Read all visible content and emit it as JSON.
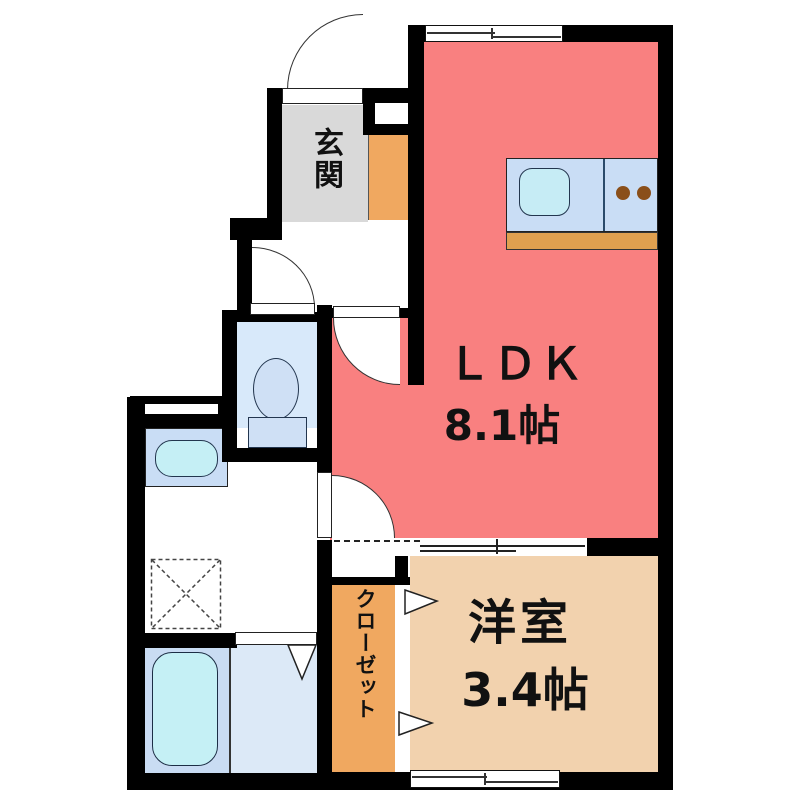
{
  "plan": {
    "rooms": {
      "ldk": {
        "label": "ＬＤＫ",
        "size": "8.1帖",
        "color": "#f98080"
      },
      "western_room": {
        "label": "洋室",
        "size": "3.4帖",
        "color": "#f2d2ae"
      },
      "entrance": {
        "label": "玄関",
        "color": "#d9d9d9"
      },
      "closet": {
        "label": "クローゼット",
        "color": "#f0a860"
      }
    },
    "fixtures": {
      "kitchen_counter": "kitchen-counter-with-sink-and-two-burner-stove",
      "toilet": "toilet",
      "washbasin": "washbasin-counter",
      "washing_machine_pan": "washing-machine-pan",
      "bathtub": "bathtub",
      "bathroom_folding_door": "folding-door",
      "closet_folding_doors": "folding-doors",
      "sliding_window_north": "sliding-window",
      "sliding_window_south": "sliding-window",
      "sliding_partition": "sliding-partition"
    },
    "colors": {
      "wall": "#000000",
      "ldk_red": "#f98080",
      "western_tan": "#f2d2ae",
      "orange": "#f0a860",
      "counter_base_orange": "#e0a04f",
      "entrance_gray": "#d9d9d9",
      "fixture_blue": "#cfe0f5",
      "counter_blue": "#c9ddf5",
      "water_cyan": "#c5eff5",
      "toilet_floor_blue": "#d8e9fa",
      "bathroom_floor_blue": "#dce9f7",
      "burner_brown": "#8a4f1a"
    }
  }
}
